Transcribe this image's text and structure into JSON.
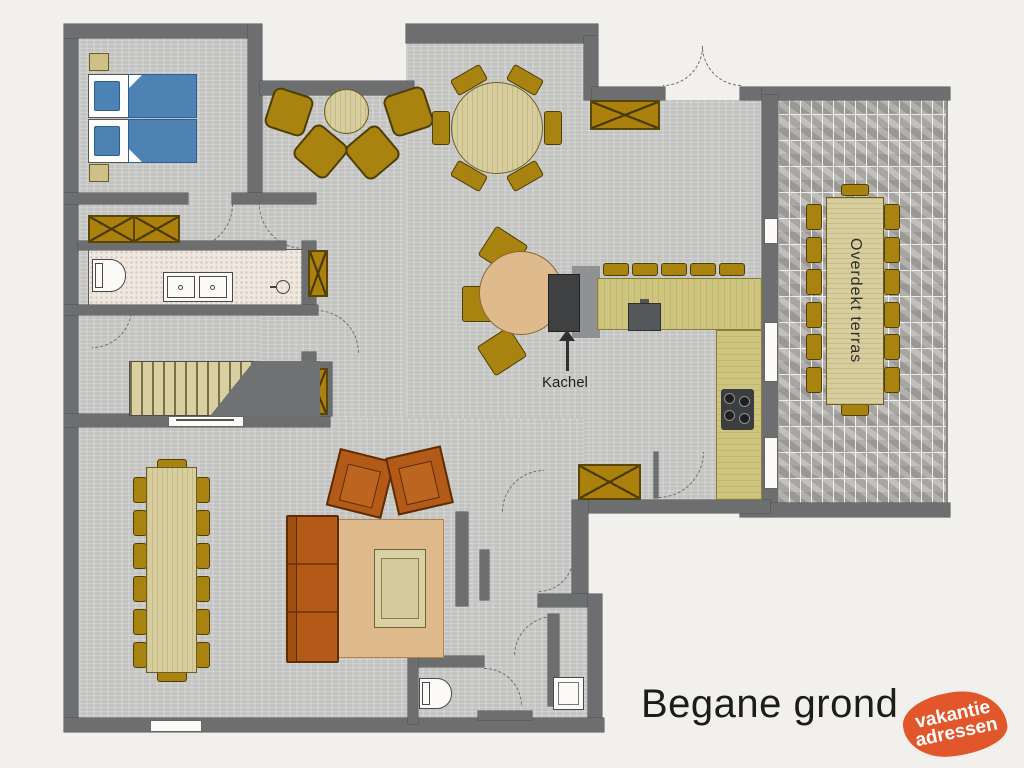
{
  "title": "Begane grond",
  "labels": {
    "stove": "Kachel",
    "terrace": "Overdekt terras"
  },
  "logo": {
    "line1": "vakantie",
    "line2": "adressen"
  },
  "colors": {
    "background": "#f2f0ec",
    "floor": "#c9cac8",
    "wall": "#6c6e70",
    "tile": "#efe8e1",
    "wood": "#d7cd9d",
    "counter": "#cdc47e",
    "gold": "#a8830f",
    "bed_blue": "#4d82b5",
    "sofa": "#b45a18",
    "rug": "#ddb98b",
    "table_tan": "#deba8c",
    "brick": "#b3b1ad",
    "stove_dark": "#3e4041",
    "logo_orange": "#e2562b",
    "text": "#1c1c1c"
  }
}
